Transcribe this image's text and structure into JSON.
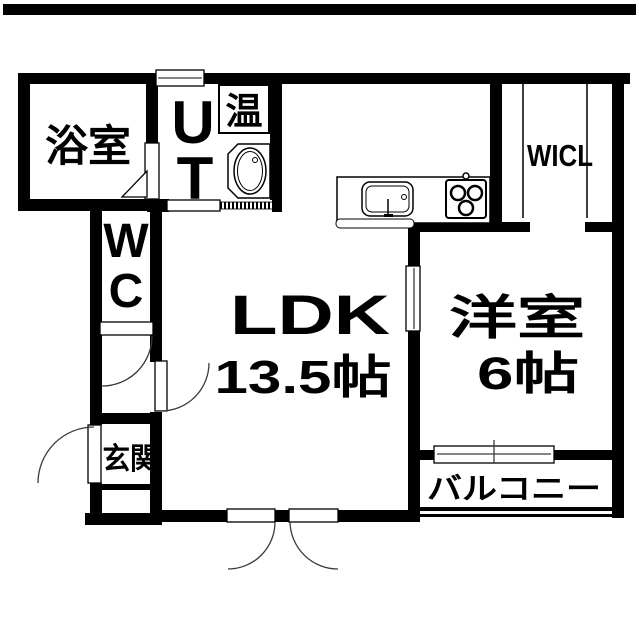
{
  "title": "1LDK apartment floor plan",
  "colors": {
    "wall": "#000000",
    "background": "#ffffff",
    "door_arc": "#3a3a3a"
  },
  "rooms": {
    "bathroom": {
      "label": "浴室"
    },
    "utility": {
      "line1": "U",
      "line2": "T"
    },
    "water_heater": {
      "label": "温"
    },
    "walk_in_closet": {
      "label": "WICL"
    },
    "toilet": {
      "line1": "W",
      "line2": "C"
    },
    "ldk": {
      "label": "LDK",
      "size": "13.5帖"
    },
    "western_room": {
      "label": "洋室",
      "size": "6帖"
    },
    "entrance": {
      "label": "玄関"
    },
    "balcony": {
      "label": "バルコニー"
    }
  }
}
